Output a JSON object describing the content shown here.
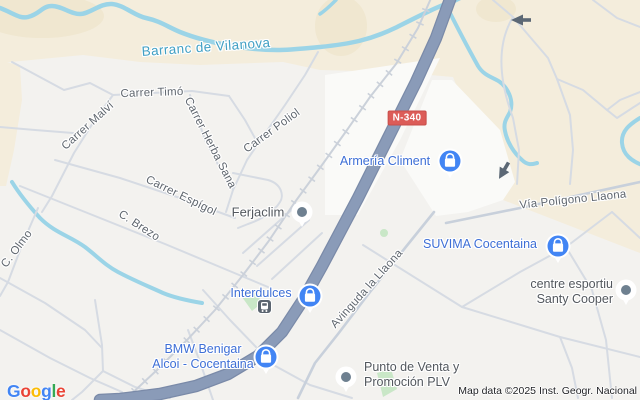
{
  "water": {
    "river_label": "Barranc de Vilanova"
  },
  "roads": {
    "route_badge": "N-340",
    "street_labels": [
      "Carrer Timó",
      "Carrer Malví",
      "Carrer Herba Sana",
      "Carrer Poliol",
      "Carrer Espígol",
      "C. Brezo",
      "C. Olmo",
      "Vía Polígono Llaona",
      "Avinguda la Llaona"
    ]
  },
  "places": {
    "armeria": "Armería Climent",
    "interdulces": "Interdulces",
    "suvima": "SUVIMA Cocentaina",
    "bmw_line1": "BMW Benigar",
    "bmw_line2": "Alcoi - Cocentaina",
    "ferjaclim": "Ferjaclim",
    "esportiu_line1": "centre esportiu",
    "esportiu_line2": "Santy Cooper",
    "punto_line1": "Punto de Venta y",
    "punto_line2": "Promoción PLV"
  },
  "footer": {
    "logo_letters": [
      {
        "ch": "G",
        "color": "#4285F4"
      },
      {
        "ch": "o",
        "color": "#EA4335"
      },
      {
        "ch": "o",
        "color": "#FBBC05"
      },
      {
        "ch": "g",
        "color": "#4285F4"
      },
      {
        "ch": "l",
        "color": "#34A853"
      },
      {
        "ch": "e",
        "color": "#EA4335"
      }
    ],
    "attribution": "Map data ©2025 Inst. Geogr. Nacional"
  },
  "colors": {
    "terrain": "#f4eddc",
    "urban": "#f3f2ef",
    "water": "#9bd4e7",
    "main_road": "#8a9bb8",
    "railway": "#cbd1da",
    "minor_street": "#d6dbe3",
    "poi_label_blue": "#3e6fd6",
    "pin_blue": "#4285F4",
    "street_label_gray": "#5f666e",
    "water_label_teal": "#42a0c4",
    "route_badge_red": "#dc5c58",
    "park_green": "#c9e7c7"
  }
}
